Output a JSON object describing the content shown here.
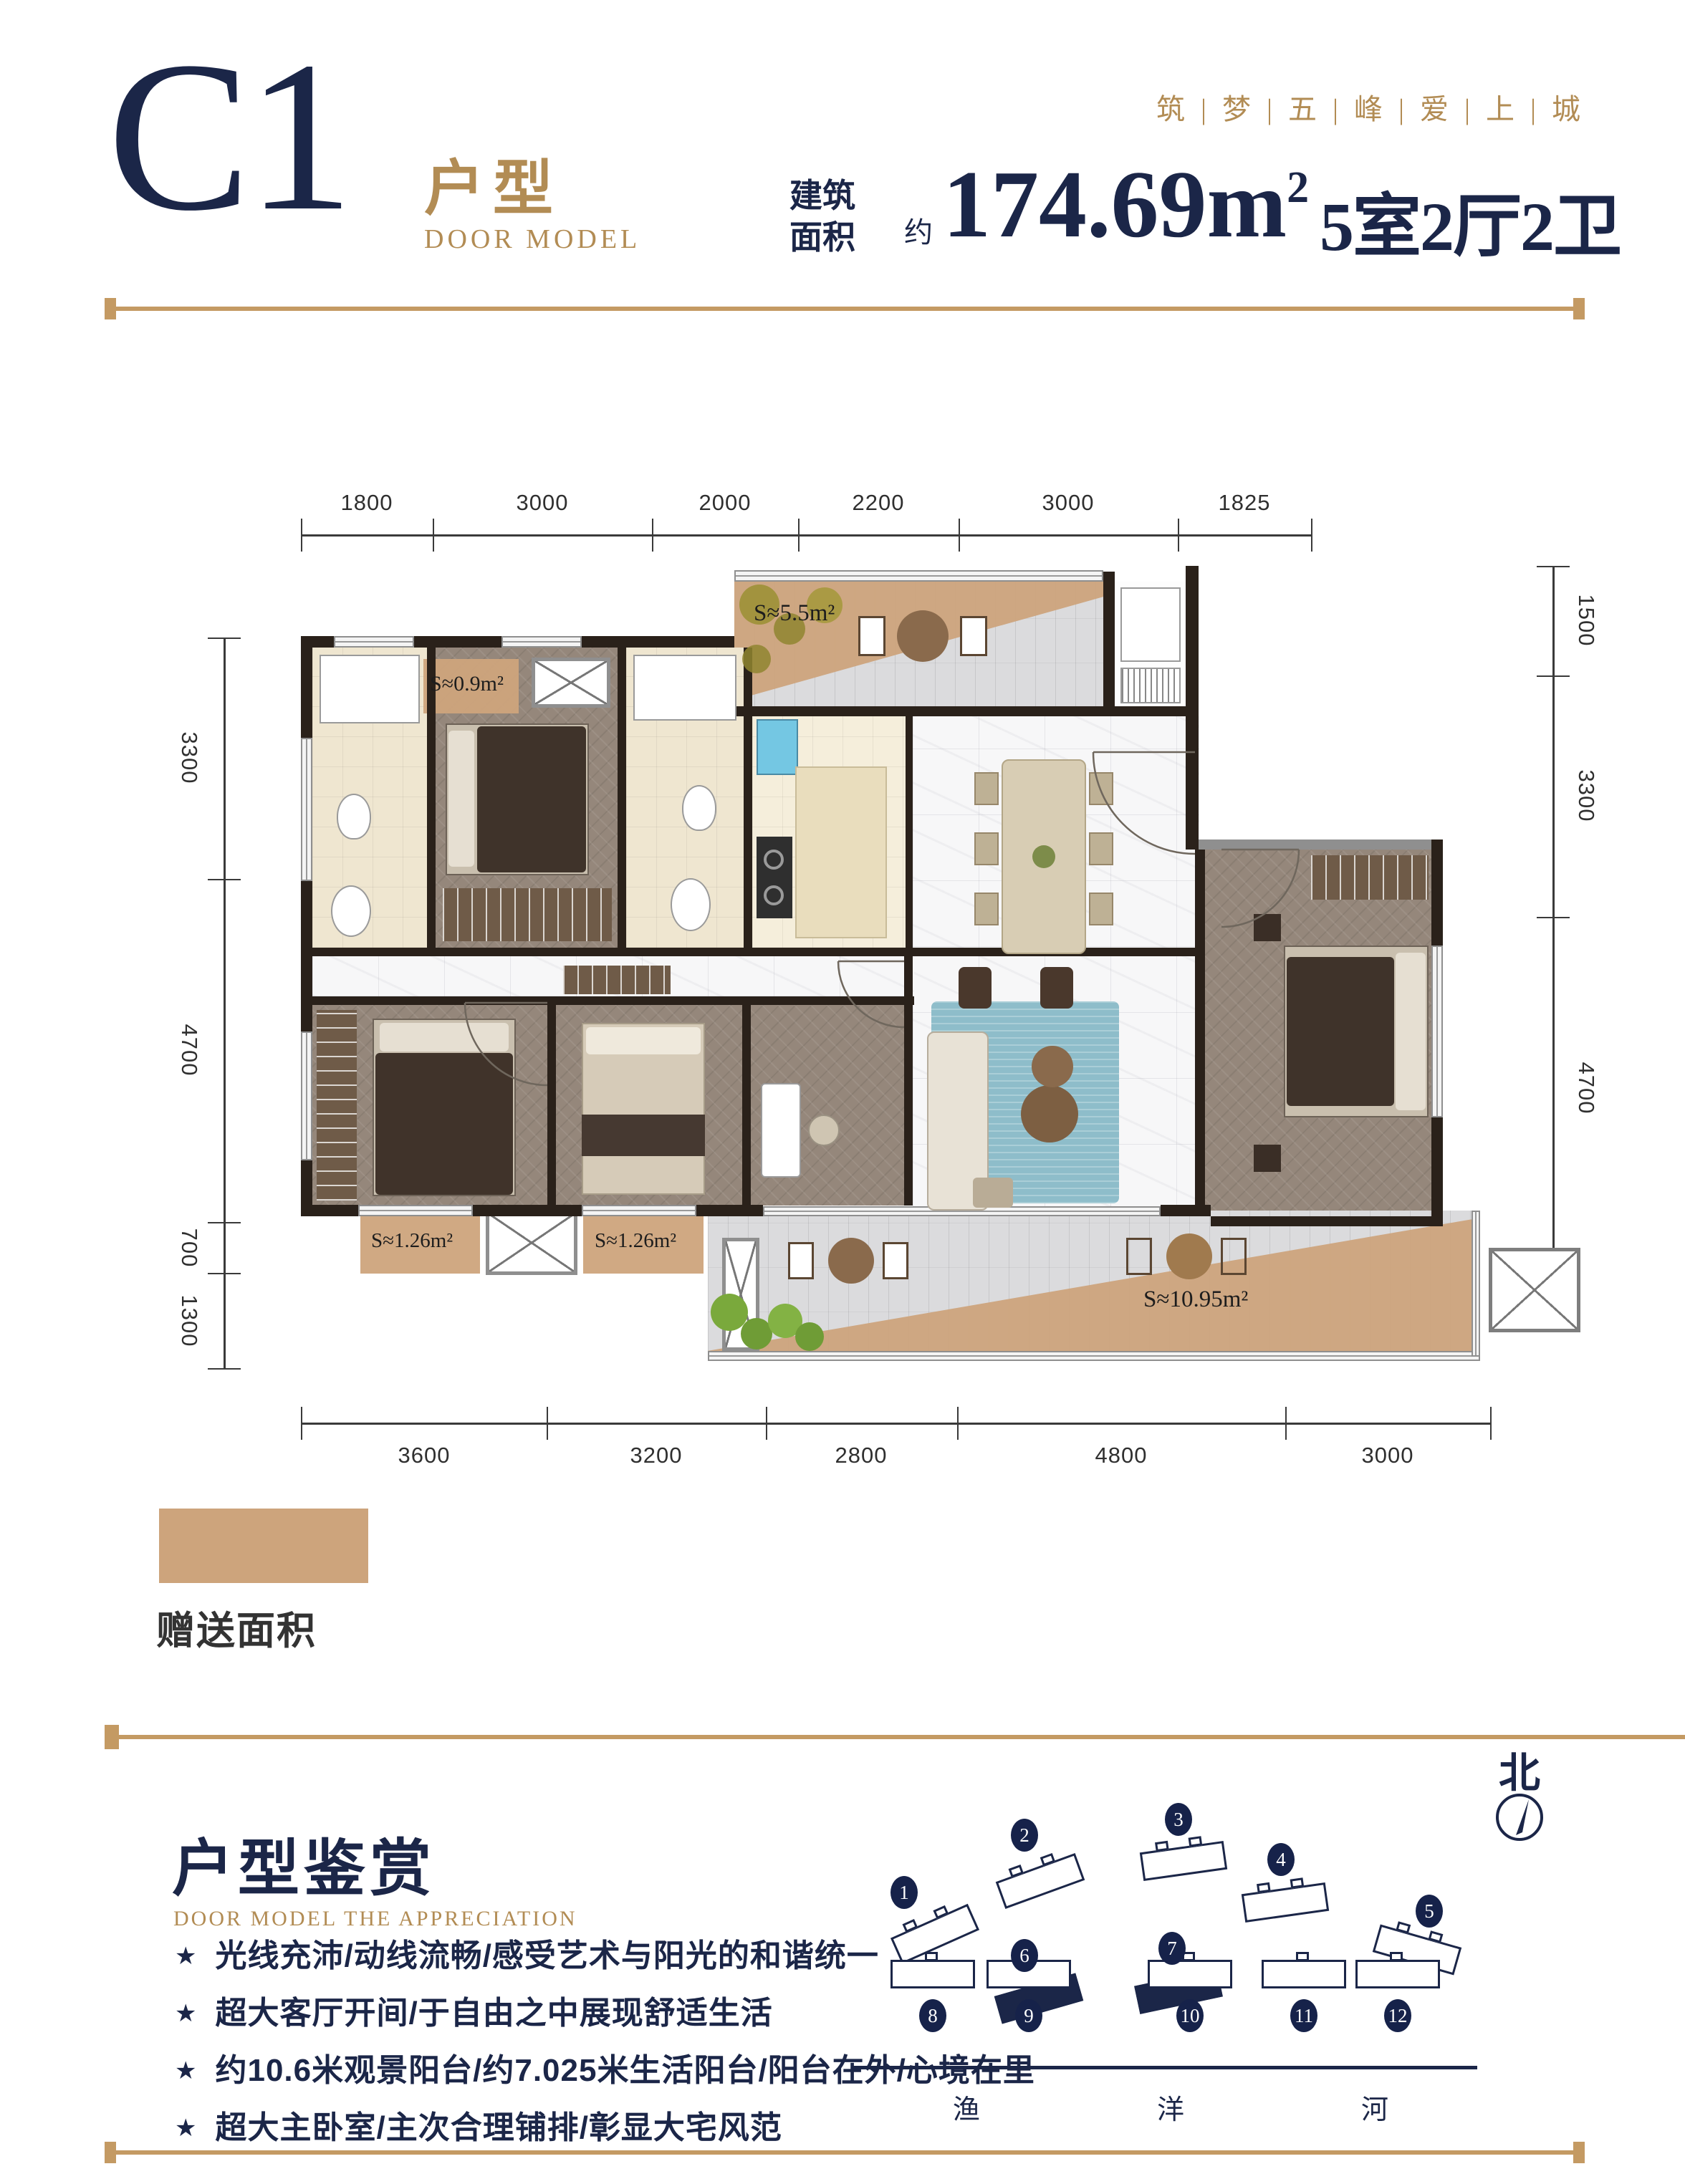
{
  "header": {
    "plan_code": "C1",
    "plan_type_cn": "户型",
    "plan_type_en": "DOOR MODEL",
    "slogan": "筑 | 梦 | 五 | 峰 | 爱 | 上 | 城",
    "area_prefix_line1": "建筑",
    "area_prefix_line2": "面积",
    "approx": "约",
    "area_value": "174.69m",
    "area_sup": "2",
    "layout_summary": "5室2厅2卫"
  },
  "plan": {
    "dimensions": {
      "top": [
        "1800",
        "3000",
        "2000",
        "2200",
        "3000",
        "1825"
      ],
      "left": [
        "3300",
        "4700",
        "700",
        "1300"
      ],
      "right": [
        "1500",
        "3300",
        "4700"
      ],
      "bottom": [
        "3600",
        "3200",
        "2800",
        "4800",
        "3000"
      ]
    },
    "areas": {
      "top_balcony": "S≈5.5m²",
      "top_bay": "S≈0.9m²",
      "bottom_bay_left": "S≈1.26m²",
      "bottom_bay_mid": "S≈1.26m²",
      "bottom_balcony": "S≈10.95m²"
    }
  },
  "legend": {
    "gift_label": "赠送面积"
  },
  "appreciation": {
    "title": "户型鉴赏",
    "subtitle": "DOOR MODEL THE APPRECIATION",
    "star": "★",
    "features": [
      "光线充沛/动线流畅/感受艺术与阳光的和谐统一",
      "超大客厅开间/于自由之中展现舒适生活",
      "约10.6米观景阳台/约7.025米生活阳台/阳台在外/心境在里",
      "超大主卧室/主次合理铺排/彰显大宅风范"
    ]
  },
  "site": {
    "north": "北",
    "buildings": [
      "1",
      "2",
      "3",
      "4",
      "5",
      "6",
      "7",
      "8",
      "9",
      "10",
      "11",
      "12"
    ],
    "rivers": [
      "渔",
      "洋",
      "河"
    ]
  },
  "colors": {
    "gold": "#b28c54",
    "navy": "#1b2648",
    "gift_tan": "#cda47c"
  }
}
